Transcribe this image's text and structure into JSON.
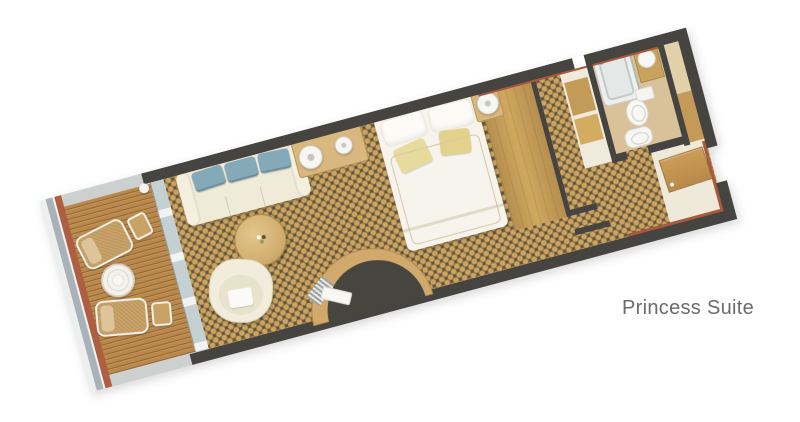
{
  "label": {
    "text": "Princess Suite"
  },
  "colors": {
    "page_bg": "#ffffff",
    "label": "#6b6b6b",
    "wall": "#454440",
    "carpet_base": "#56544a",
    "carpet_dot": "#cda45f",
    "deck_wood": "#b9884a",
    "hull_trim": "#ae5f41",
    "hull_band": "#a9b2b8",
    "sofa_body": "#f0ead8",
    "sofa_cushion": "#84a9b8",
    "accent_pillow": "#e7da9d",
    "furniture_wood": "#c49a58",
    "bath_floor": "#d9c299",
    "linen_white": "#f6f4ec",
    "entry_floor": "#efe9d9"
  }
}
